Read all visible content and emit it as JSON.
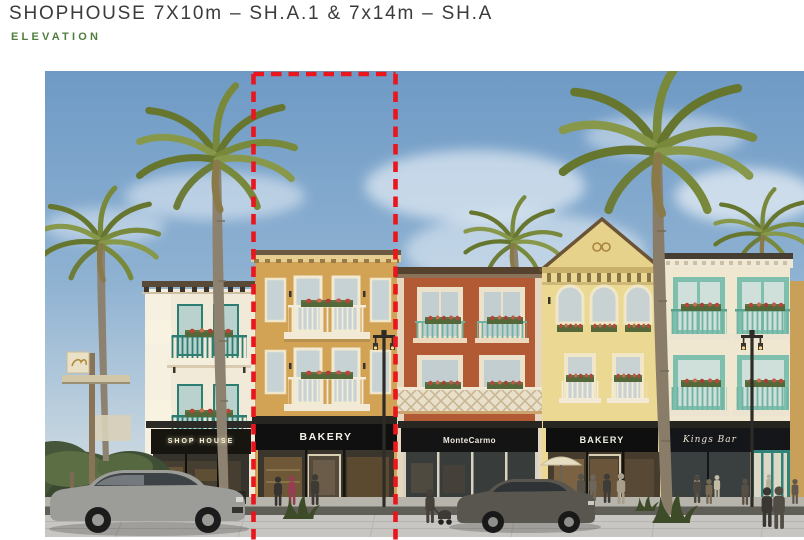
{
  "header": {
    "title": "SHOPHOUSE 7X10m – SH.A.1 & 7x14m – SH.A",
    "subtitle": "ELEVATION",
    "title_color": "#3b3b3b",
    "subtitle_color": "#4f7d3e"
  },
  "rendering": {
    "type": "architectural street elevation rendering of three-storey mediterranean shophouses",
    "highlight": {
      "style": "red dashed outline",
      "color": "#e9161d",
      "marks": "center shophouse unit"
    },
    "signs": {
      "motel": "MOTEL",
      "shophouse": "SHOP HOUSE",
      "bakery_center": "BAKERY",
      "montecarmo": "MonteCarmo",
      "bakery_right": "BAKERY",
      "kings_bar": "Kings Bar"
    },
    "palette": {
      "sky": "#7fa5cb",
      "building_cream": "#f1ead8",
      "building_tan": "#d2a355",
      "building_terracotta": "#b25a33",
      "building_yellow": "#ead893",
      "building_offwhite": "#efe7d0",
      "accent_teal": "#3f8f82",
      "accent_mint": "#7fbfae",
      "pavement": "#c7c6c2",
      "motel_sign_red": "#6d1a18"
    }
  }
}
